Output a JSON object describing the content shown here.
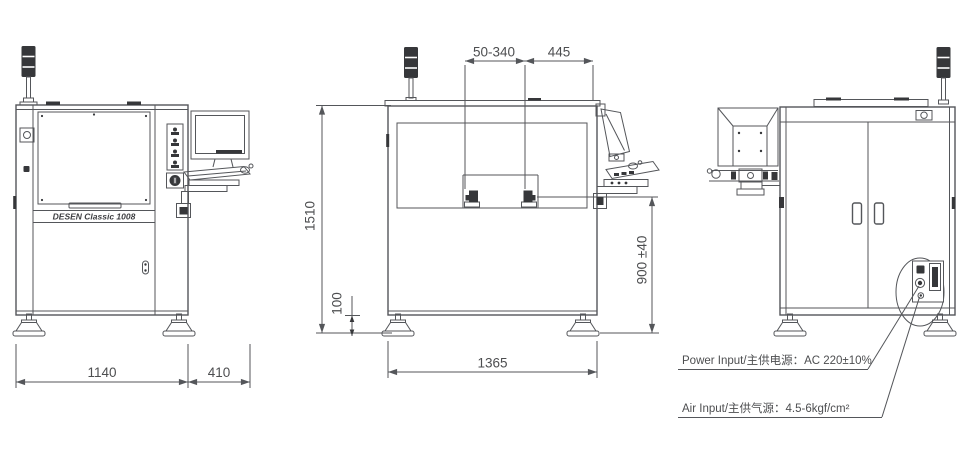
{
  "document": {
    "type": "machine-outline-dimension-drawing",
    "model": "DESEN Classic 1008"
  },
  "logo": {
    "text": "DESEN Classic 1008"
  },
  "dimensions": {
    "front_width": "1140",
    "console_width": "410",
    "board_range": "50-340",
    "clamp_to_edge": "445",
    "total_height": "1510",
    "foot_height": "100",
    "conveyor_height": "900 ±40",
    "depth": "1365"
  },
  "annotations": {
    "power": "Power Input/主供电源：AC 220±10%",
    "air": "Air Input/主供气源：4.5-6kgf/cm²"
  },
  "colors": {
    "line": "#54565a",
    "dark_fill": "#36373a",
    "text": "#4d4e50",
    "background": "#ffffff"
  }
}
